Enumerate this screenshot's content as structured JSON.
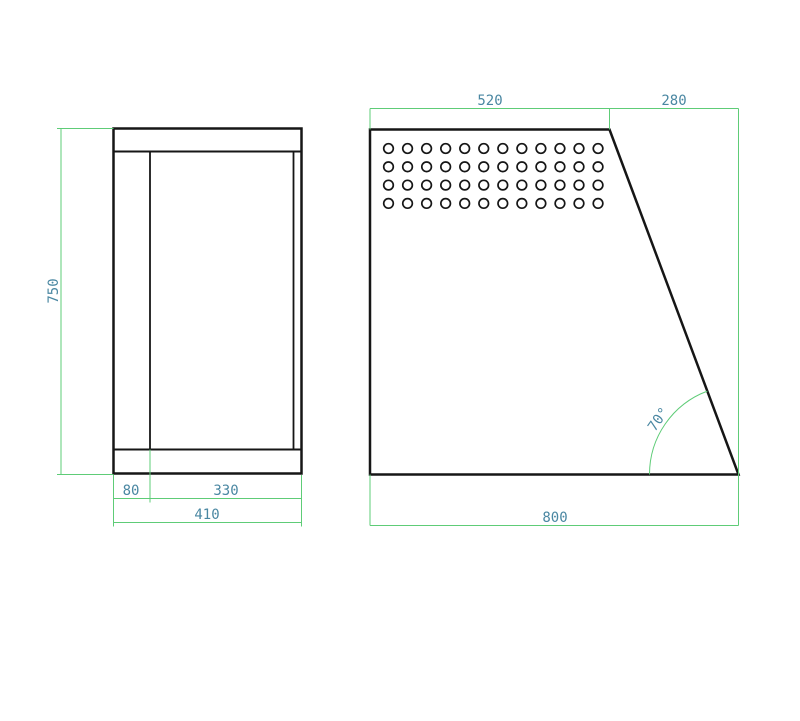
{
  "drawing": {
    "type": "technical-drawing",
    "front_view": {
      "dim_height": "750",
      "dim_width_left": "80",
      "dim_width_right": "330",
      "dim_width_total": "410"
    },
    "side_view": {
      "dim_top_left": "520",
      "dim_top_right": "280",
      "dim_bottom": "800",
      "angle": "70°",
      "holes": {
        "rows": 4,
        "cols": 12
      }
    }
  },
  "colors": {
    "geometry": "#161616",
    "dimension_line": "#5ecc77",
    "dimension_text": "#4a87a2"
  }
}
